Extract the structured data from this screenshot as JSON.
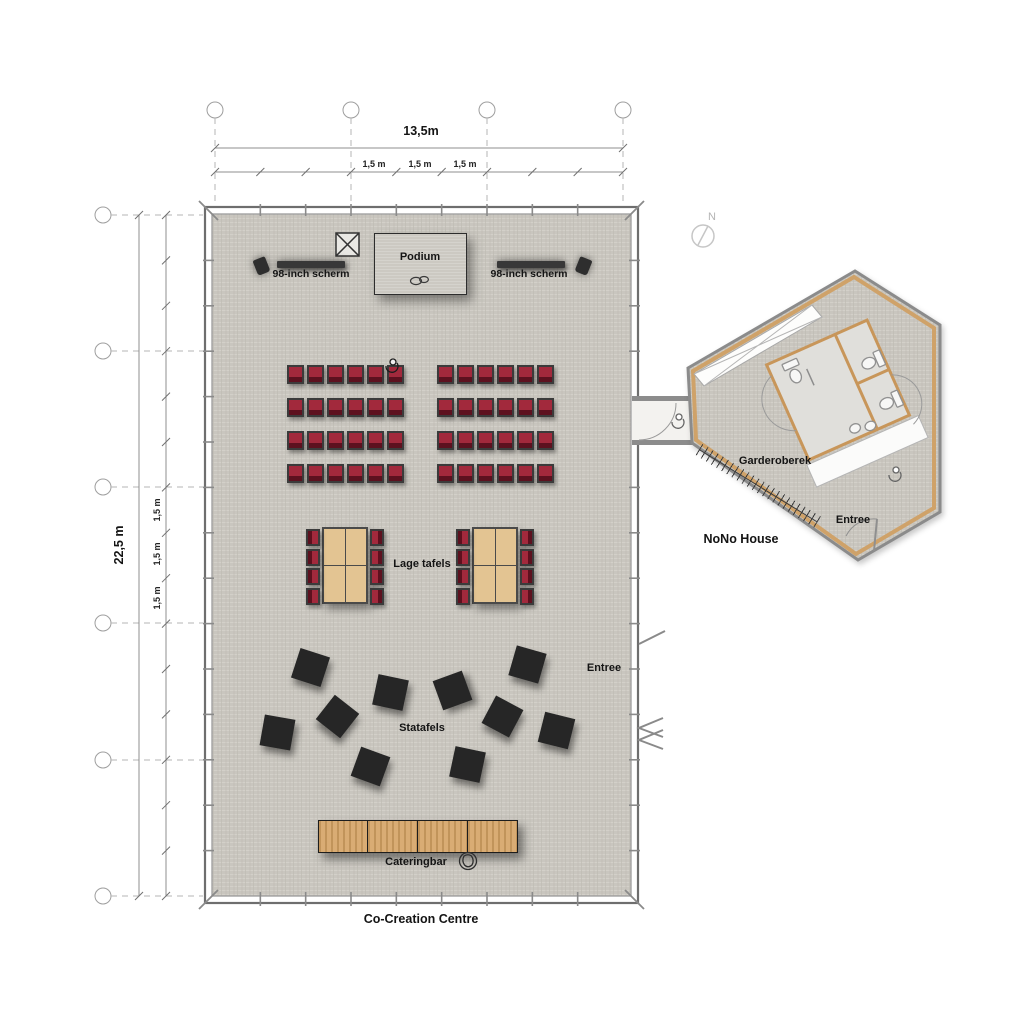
{
  "plan": {
    "hall_label": "Co-Creation Centre",
    "nono_label": "NoNo House"
  },
  "compass": {
    "north_label": "N"
  },
  "dimensions": {
    "overall_width": "13,5m",
    "overall_depth": "22,5 m",
    "top_segments": [
      "1,5 m",
      "1,5 m",
      "1,5 m"
    ],
    "side_segments": [
      "1,5 m",
      "1,5 m",
      "1,5 m"
    ]
  },
  "stage": {
    "podium_label": "Podium",
    "screen_left_label": "98-inch scherm",
    "screen_right_label": "98-inch scherm"
  },
  "areas": {
    "low_tables_label": "Lage tafels",
    "standing_tables_label": "Statafels",
    "catering_label": "Cateringbar",
    "hall_entrance_label": "Entree",
    "nono_entrance_label": "Entree",
    "wardrobe_label": "Garderoberek"
  },
  "colors": {
    "floor": "#c9c6bf",
    "chair_red": "#a2293c",
    "chair_red_dark": "#7c1e2e",
    "table_wood": "#e3c492",
    "bar_wood": "#d9ac74",
    "standing_table": "#262626",
    "wall_wood_lining": "#cfa269"
  },
  "furniture": {
    "theater_seating": {
      "blocks": [
        {
          "x": 287
        },
        {
          "x": 437
        }
      ],
      "rows_y": [
        365,
        398,
        431,
        464
      ],
      "seats_per_row": 6,
      "seat_pitch": 20,
      "seat_w": 17,
      "seat_h": 19
    },
    "low_tables": {
      "groups_x": [
        322,
        472
      ],
      "y": 527,
      "wood_w": 46,
      "wood_h": 77,
      "chairs_per_side": 4,
      "side_chair_w": 14,
      "side_chair_h": 17,
      "side_chair_pitch": 19.5
    },
    "standing_tables": {
      "size": 31,
      "items": [
        [
          310,
          667,
          18
        ],
        [
          390,
          692,
          12
        ],
        [
          452,
          690,
          -20
        ],
        [
          527,
          664,
          16
        ],
        [
          337,
          716,
          38
        ],
        [
          277,
          732,
          10
        ],
        [
          502,
          716,
          28
        ],
        [
          556,
          730,
          14
        ],
        [
          370,
          766,
          20
        ],
        [
          467,
          764,
          12
        ]
      ]
    },
    "catering_bar": {
      "x": 318,
      "y": 820,
      "segments": 4,
      "seg_w": 50,
      "h": 33
    }
  }
}
